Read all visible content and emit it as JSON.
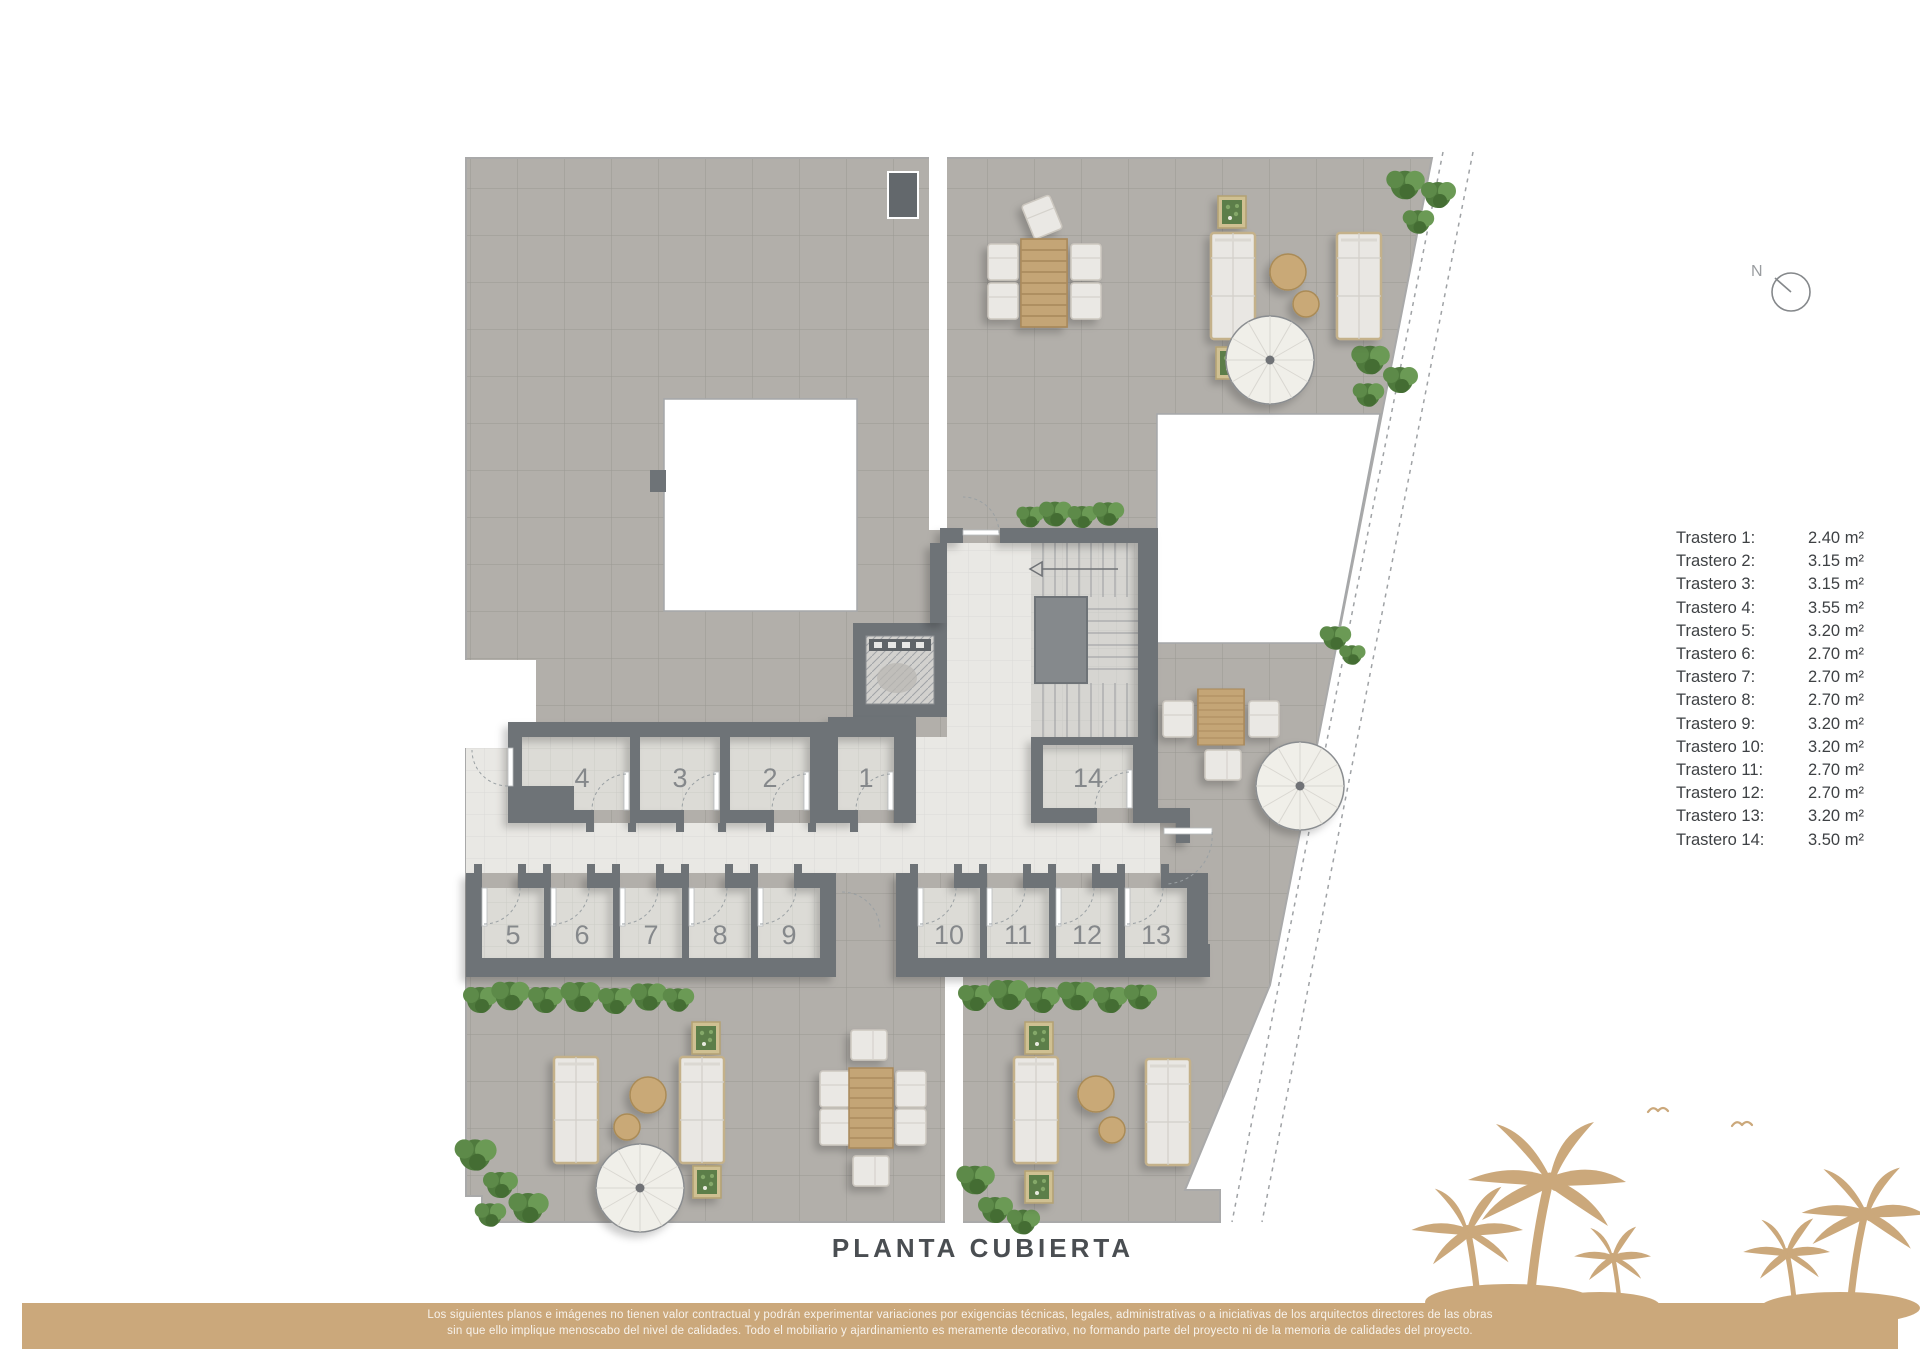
{
  "page": {
    "title_label": "PLANTA CUBIERTA"
  },
  "north": {
    "label": "N"
  },
  "legend": {
    "items": [
      {
        "label": "Trastero 1:",
        "value": "2.40 m²"
      },
      {
        "label": "Trastero 2:",
        "value": "3.15 m²"
      },
      {
        "label": "Trastero 3:",
        "value": "3.15 m²"
      },
      {
        "label": "Trastero 4:",
        "value": "3.55 m²"
      },
      {
        "label": "Trastero 5:",
        "value": "3.20 m²"
      },
      {
        "label": "Trastero 6:",
        "value": "2.70 m²"
      },
      {
        "label": "Trastero 7:",
        "value": "2.70 m²"
      },
      {
        "label": "Trastero 8:",
        "value": "2.70 m²"
      },
      {
        "label": "Trastero 9:",
        "value": "3.20 m²"
      },
      {
        "label": "Trastero 10:",
        "value": "3.20 m²"
      },
      {
        "label": "Trastero 11:",
        "value": "2.70 m²"
      },
      {
        "label": "Trastero 12:",
        "value": "2.70 m²"
      },
      {
        "label": "Trastero 13:",
        "value": "3.20 m²"
      },
      {
        "label": "Trastero 14:",
        "value": "3.50 m²"
      }
    ]
  },
  "rooms": [
    {
      "number": "1"
    },
    {
      "number": "2"
    },
    {
      "number": "3"
    },
    {
      "number": "4"
    },
    {
      "number": "5"
    },
    {
      "number": "6"
    },
    {
      "number": "7"
    },
    {
      "number": "8"
    },
    {
      "number": "9"
    },
    {
      "number": "10"
    },
    {
      "number": "11"
    },
    {
      "number": "12"
    },
    {
      "number": "13"
    },
    {
      "number": "14"
    }
  ],
  "disclaimer": {
    "line1": "Los siguientes planos e imágenes no tienen valor contractual y podrán experimentar variaciones por exigencias técnicas, legales, administrativas o a iniciativas de los arquitectos directores de las obras",
    "line2": "sin que ello implique menoscabo del nivel de calidades. Todo el mobiliario y ajardinamiento es meramente decorativo, no formando parte del proyecto ni de la memoria de calidades del proyecto."
  },
  "colors": {
    "banner": "#cba87b",
    "wall": "#6e7377",
    "terrace": "#b2afaa",
    "corridor": "#e9e8e4",
    "greenery": "#4f7a3d",
    "wood": "#c4a576"
  }
}
